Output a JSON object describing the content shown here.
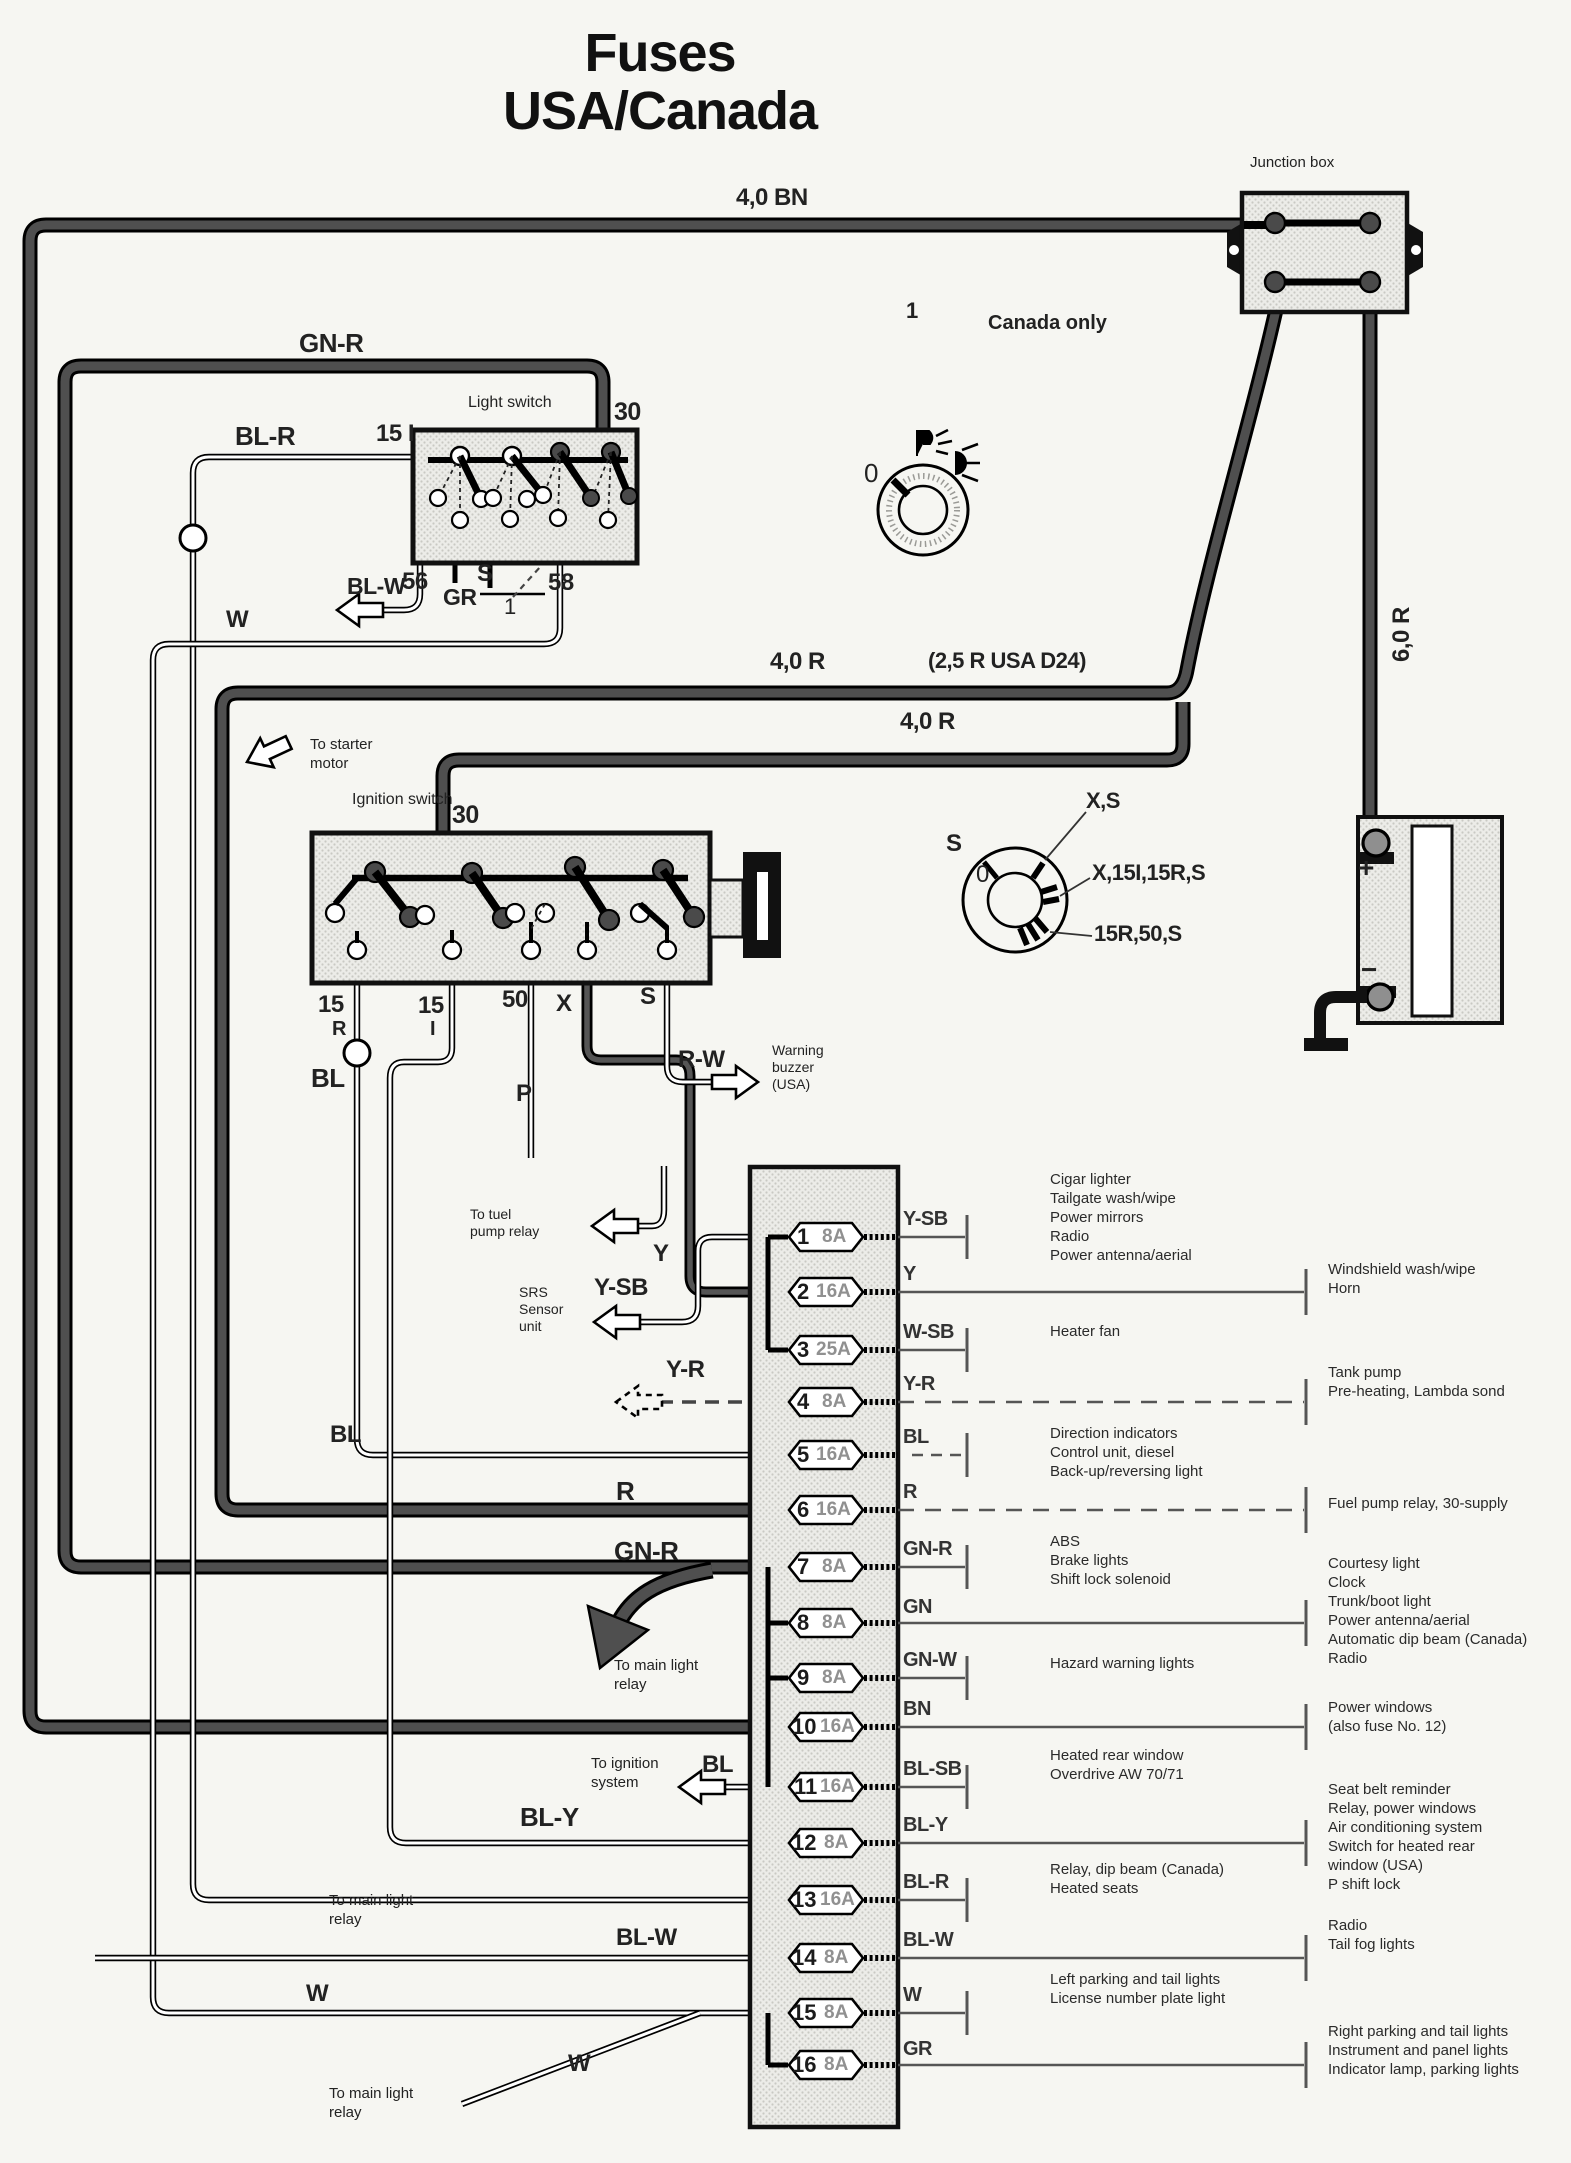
{
  "title": {
    "line1": "Fuses",
    "line2": "USA/Canada"
  },
  "colors": {
    "paper": "#f6f6f2",
    "ink": "#1b1b1b",
    "thick_wire": "#4f4f4f",
    "hatch": "#c9c9c3"
  },
  "junction_box": {
    "label": "Junction box"
  },
  "battery": {
    "plus": "+",
    "minus": "−",
    "wire": "6,0 R"
  },
  "labels": {
    "bn40": "4,0 BN",
    "gnr_top": "GN-R",
    "blr": "BL-R",
    "ls_15i": "15 I",
    "light_switch": "Light switch",
    "ls_30": "30",
    "blw1": "BL-W",
    "t56": "56",
    "gr1": "GR",
    "s1": "S",
    "one1": "1",
    "t58": "58",
    "w1": "W",
    "canada_num": "1",
    "canada_only": "Canada only",
    "knob_0": "0",
    "r40a": "4,0 R",
    "r25usa": "(2,5 R USA D24)",
    "r40b": "4,0 R",
    "to_starter": "To starter\nmotor",
    "ignition_switch": "Ignition switch",
    "ign_30": "30",
    "t15a": "15",
    "tRa": "R",
    "t15b": "15",
    "tIb": "I",
    "t50": "50",
    "tX": "X",
    "tSi": "S",
    "bl_ign": "BL",
    "p1": "P",
    "rw": "R-W",
    "warning": "Warning\nbuzzer\n(USA)",
    "key_s": "S",
    "key_0": "0",
    "key_xs": "X,S",
    "key_x15": "X,15I,15R,S",
    "key_1550": "15R,50,S",
    "r60": "6,0 R",
    "to_fuel": "To tuel\npump relay",
    "srs": "SRS\nSensor\nunit",
    "ysb_l": "Y-SB",
    "y_l": "Y",
    "yr_l": "Y-R",
    "bl_f5": "BL",
    "r_f6": "R",
    "gnr_f7": "GN-R",
    "to_main1": "To main light\nrelay",
    "to_ign": "To ignition\nsystem",
    "bl_f11": "BL",
    "bly_l": "BL-Y",
    "blw_f14": "BL-W",
    "to_main2": "To main light\nrelay",
    "w_f15": "W",
    "to_main3": "To main light\nrelay",
    "w_diag": "W"
  },
  "fuses": [
    {
      "no": "1",
      "amp": "8A",
      "code": "Y-SB",
      "consumers": "Cigar lighter\nTailgate wash/wipe\nPower mirrors\nRadio\nPower antenna/aerial"
    },
    {
      "no": "2",
      "amp": "16A",
      "code": "Y",
      "consumers": "Windshield wash/wipe\nHorn"
    },
    {
      "no": "3",
      "amp": "25A",
      "code": "W-SB",
      "consumers": "Heater fan"
    },
    {
      "no": "4",
      "amp": "8A",
      "code": "Y-R",
      "consumers": "Tank pump\nPre-heating, Lambda sond"
    },
    {
      "no": "5",
      "amp": "16A",
      "code": "BL",
      "consumers": "Direction indicators\nControl unit, diesel\nBack-up/reversing light"
    },
    {
      "no": "6",
      "amp": "16A",
      "code": "R",
      "consumers": "Fuel pump relay, 30-supply"
    },
    {
      "no": "7",
      "amp": "8A",
      "code": "GN-R",
      "consumers": "ABS\nBrake lights\nShift lock solenoid"
    },
    {
      "no": "8",
      "amp": "8A",
      "code": "GN",
      "consumers": "Courtesy light\nClock\nTrunk/boot light\nPower antenna/aerial\nAutomatic dip beam (Canada)\nRadio"
    },
    {
      "no": "9",
      "amp": "8A",
      "code": "GN-W",
      "consumers": "Hazard warning lights"
    },
    {
      "no": "10",
      "amp": "16A",
      "code": "BN",
      "consumers": "Power windows\n(also fuse No. 12)"
    },
    {
      "no": "11",
      "amp": "16A",
      "code": "BL-SB",
      "consumers": "Heated rear window\nOverdrive AW 70/71"
    },
    {
      "no": "12",
      "amp": "8A",
      "code": "BL-Y",
      "consumers": "Seat belt reminder\nRelay, power windows\nAir conditioning system\nSwitch for heated rear\nwindow (USA)\nP shift lock"
    },
    {
      "no": "13",
      "amp": "16A",
      "code": "BL-R",
      "consumers": "Relay, dip beam (Canada)\nHeated seats"
    },
    {
      "no": "14",
      "amp": "8A",
      "code": "BL-W",
      "consumers": "Radio\nTail fog lights"
    },
    {
      "no": "15",
      "amp": "8A",
      "code": "W",
      "consumers": "Left parking and tail lights\nLicense number plate light"
    },
    {
      "no": "16",
      "amp": "8A",
      "code": "GR",
      "consumers": "Right parking and tail lights\nInstrument and panel lights\nIndicator lamp, parking lights"
    }
  ]
}
